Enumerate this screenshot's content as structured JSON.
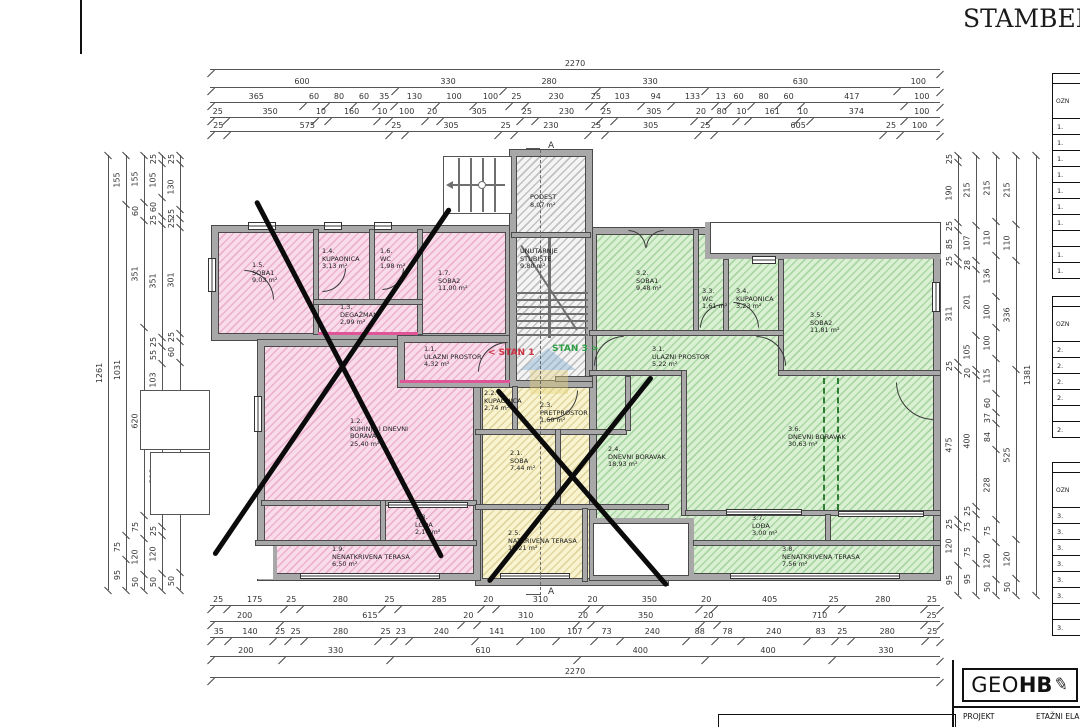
{
  "title": "STAMBEN",
  "section_marker": {
    "top": "A",
    "bottom": "A"
  },
  "watermarks": {
    "stan1": "< STAN 1",
    "stan3": "STAN 3 >"
  },
  "dims": {
    "top": [
      [
        "2270"
      ],
      [
        "600",
        "330",
        "280",
        "330",
        "630",
        "100"
      ],
      [
        "365",
        "60",
        "80",
        "60",
        "35",
        "130",
        "100",
        "100",
        "25",
        "230",
        "25",
        "103",
        "94",
        "133",
        "13",
        "60",
        "80",
        "60",
        "417",
        "100"
      ],
      [
        "25",
        "350",
        "10",
        "160",
        "10",
        "100",
        "20",
        "305",
        "25",
        "230",
        "25",
        "305",
        "20",
        "80",
        "10",
        "161",
        "10",
        "374",
        "100"
      ],
      [
        "25",
        "575",
        "25",
        "305",
        "25",
        "230",
        "25",
        "305",
        "25",
        "605",
        "25",
        "100"
      ]
    ],
    "bottom": [
      [
        "25",
        "175",
        "25",
        "280",
        "25",
        "285",
        "20",
        "310",
        "20",
        "350",
        "20",
        "405",
        "25",
        "280",
        "25"
      ],
      [
        "200",
        "615",
        "20",
        "310",
        "20",
        "350",
        "20",
        "710",
        "25"
      ],
      [
        "35",
        "140",
        "25",
        "25",
        "280",
        "25",
        "23",
        "240",
        "141",
        "100",
        "107",
        "73",
        "240",
        "88",
        "78",
        "240",
        "83",
        "25",
        "280",
        "25"
      ],
      [
        "200",
        "330",
        "610",
        "400",
        "400",
        "330"
      ],
      [
        "2270"
      ]
    ],
    "left": [
      [
        "1261"
      ],
      [
        "155",
        "1031",
        "75",
        "95"
      ],
      [
        "155",
        "60",
        "351",
        "620",
        "75",
        "120",
        "50"
      ],
      [
        "25",
        "105",
        "60",
        "25",
        "351",
        "25",
        "55",
        "103",
        "84",
        "318",
        "25",
        "120",
        "50"
      ],
      [
        "25",
        "130",
        "25",
        "25",
        "301",
        "25",
        "60",
        "595",
        "50"
      ]
    ],
    "right": [
      [
        "25",
        "190",
        "25",
        "85",
        "25",
        "311",
        "25",
        "475",
        "25",
        "120",
        "95"
      ],
      [
        "215",
        "107",
        "28",
        "201",
        "105",
        "20",
        "400",
        "25",
        "75",
        "75",
        "95"
      ],
      [
        "215",
        "110",
        "136",
        "100",
        "100",
        "115",
        "60",
        "37",
        "84",
        "228",
        "75",
        "120",
        "50"
      ],
      [
        "215",
        "110",
        "336",
        "525",
        "120",
        "50"
      ],
      [
        "1381"
      ]
    ]
  },
  "plan": {
    "stan1": {
      "rooms": [
        {
          "id": "1.1.",
          "name": "ULAZNI PROSTOR",
          "area": "4,32 m²"
        },
        {
          "id": "1.2.",
          "name": "KUHINJA I DNEVNI BORAVAK",
          "area": "25,40 m²"
        },
        {
          "id": "1.3.",
          "name": "DEGAŽMAN",
          "area": "2,99 m²"
        },
        {
          "id": "1.4.",
          "name": "KUPAONICA",
          "area": "3,13 m²"
        },
        {
          "id": "1.5.",
          "name": "SOBA1",
          "area": "9,03 m²"
        },
        {
          "id": "1.6.",
          "name": "WC",
          "area": "1,98 m²"
        },
        {
          "id": "1.7.",
          "name": "SOBA2",
          "area": "11,00 m²"
        },
        {
          "id": "1.8.",
          "name": "LOĐA",
          "area": "2,14 m²"
        },
        {
          "id": "1.9.",
          "name": "NENATKRIVENA TERASA",
          "area": "6,50 m²"
        }
      ]
    },
    "stan2": {
      "rooms": [
        {
          "id": "2.1.",
          "name": "SOBA",
          "area": "7,44 m²"
        },
        {
          "id": "2.2.",
          "name": "KUPAONICA",
          "area": "2,74 m²"
        },
        {
          "id": "2.3.",
          "name": "PRETPROSTOR",
          "area": "1,60 m²"
        },
        {
          "id": "2.4.",
          "name": "DNEVNI BORAVAK",
          "area": "18,93 m²"
        },
        {
          "id": "2.5.",
          "name": "NATKRIVENA TERASA",
          "area": "10,21 m²"
        }
      ]
    },
    "stan3": {
      "rooms": [
        {
          "id": "3.1.",
          "name": "ULAZNI PROSTOR",
          "area": "5,22 m²"
        },
        {
          "id": "3.2.",
          "name": "SOBA1",
          "area": "9,48 m²"
        },
        {
          "id": "3.3.",
          "name": "WC",
          "area": "1,61 m²"
        },
        {
          "id": "3.4.",
          "name": "KUPAONICA",
          "area": "3,23 m²"
        },
        {
          "id": "3.5.",
          "name": "SOBA2",
          "area": "11,81 m²"
        },
        {
          "id": "3.6.",
          "name": "DNEVNI BORAVAK",
          "area": "30,63 m²"
        },
        {
          "id": "3.7.",
          "name": "LOĐA",
          "area": "3,00 m²"
        },
        {
          "id": "3.8.",
          "name": "NENATKRIVENA TERASA",
          "area": "7,56 m²"
        }
      ]
    },
    "common": {
      "podest": {
        "id": "",
        "name": "PODEST",
        "area": "8,07 m²"
      },
      "stubiste": {
        "id": "",
        "name": "UNUTARNJE STUBIŠTE",
        "area": "9,80 m²"
      }
    }
  },
  "legend_tables": [
    {
      "header": "OZN",
      "rows": [
        "1.",
        "1.",
        "1.",
        "1.",
        "1.",
        "1.",
        "1.",
        "",
        "1.",
        "1."
      ]
    },
    {
      "header": "OZN",
      "rows": [
        "2.",
        "2.",
        "2.",
        "2.",
        "",
        "2."
      ]
    },
    {
      "header": "OZN",
      "rows": [
        "3.",
        "3.",
        "3.",
        "3.",
        "3.",
        "3.",
        "",
        "3."
      ]
    }
  ],
  "branding": {
    "geo": "GEO",
    "hb": "HB",
    "pencil_icon": "✎",
    "projekt_label": "PROJEKT",
    "etazni_label": "ETAŽNI ELA"
  },
  "colors": {
    "stan1_fill": "#f8dcea",
    "stan1_stripe": "#d6508c",
    "stan2_fill": "#f9f4cf",
    "stan2_stripe": "#b9a555",
    "stan3_fill": "#daf0d2",
    "stan3_stripe": "#46a046",
    "wall": "#a8a8a8",
    "accent_magenta": "#e0559a",
    "stan1_watermark": "#cc3344",
    "stan3_watermark": "#2e9e44",
    "crossout": "#0b0b0b"
  }
}
